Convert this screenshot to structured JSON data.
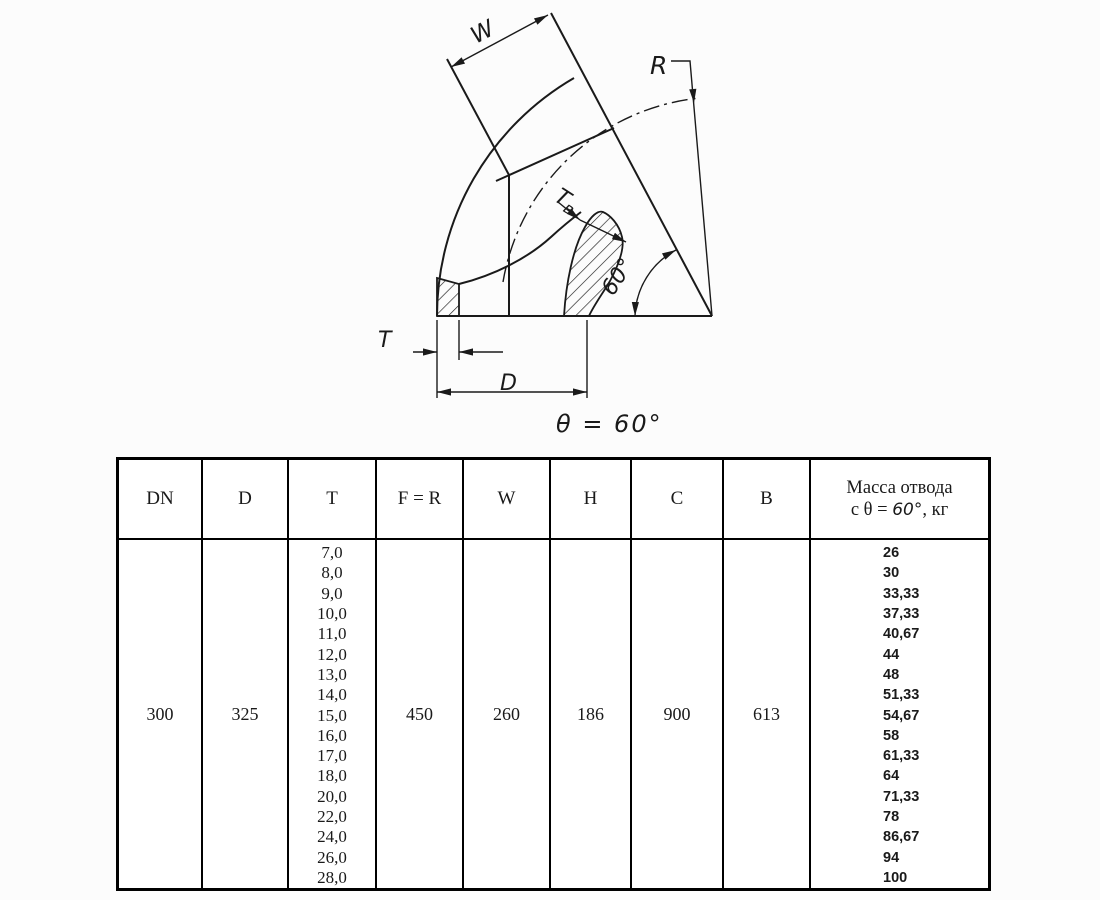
{
  "theme": {
    "ink": "#1a1a1a",
    "paper": "#fcfcfc",
    "table_bg": "#ffffff"
  },
  "drawing": {
    "dim_w": "W",
    "radius_label": "R",
    "wall_inner_label_main": "Т",
    "wall_inner_label_sub": "в",
    "angle_arc_label": "60°",
    "dim_t": "T",
    "dim_d": "D",
    "caption": "θ = 60°"
  },
  "table": {
    "headers": [
      "DN",
      "D",
      "T",
      "F = R",
      "W",
      "H",
      "C",
      "B"
    ],
    "mass_header": {
      "line1": "Масса отвода",
      "line2_prefix": "с θ = ",
      "line2_angle": "60°",
      "line2_suffix": ", кг"
    },
    "row": {
      "dn": "300",
      "d": "325",
      "t_values": [
        "7,0",
        "8,0",
        "9,0",
        "10,0",
        "11,0",
        "12,0",
        "13,0",
        "14,0",
        "15,0",
        "16,0",
        "17,0",
        "18,0",
        "20,0",
        "22,0",
        "24,0",
        "26,0",
        "28,0"
      ],
      "f_r": "450",
      "w": "260",
      "h": "186",
      "c": "900",
      "b": "613",
      "mass_values": [
        "26",
        "30",
        "33,33",
        "37,33",
        "40,67",
        "44",
        "48",
        "51,33",
        "54,67",
        "58",
        "61,33",
        "64",
        "71,33",
        "78",
        "86,67",
        "94",
        "100"
      ]
    }
  }
}
